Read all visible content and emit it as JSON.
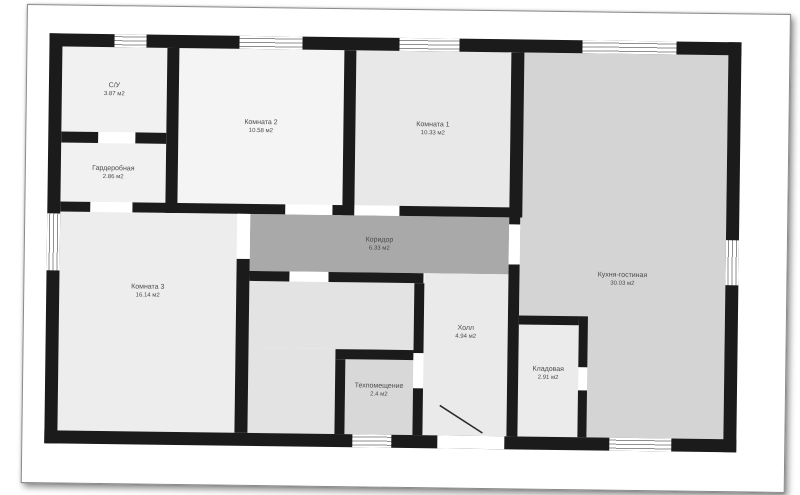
{
  "colors": {
    "wall": "#1b1b1b",
    "corridor_fill": "#a9a9a9",
    "kitchen_fill": "#d4d4d4",
    "room_fill_light": "#efefef",
    "window_line": "#8f8f8f",
    "label_text": "#4a4a4a",
    "photo_background": "#ffffff"
  },
  "plan": {
    "rooms": [
      {
        "name": "С/У",
        "area": "3.87 м2"
      },
      {
        "name": "Гардеробная",
        "area": "2.86 м2"
      },
      {
        "name": "Комната 2",
        "area": "10.58 м2"
      },
      {
        "name": "Комната 1",
        "area": "10.33 м2"
      },
      {
        "name": "Кухня-гостиная",
        "area": "30.03 м2"
      },
      {
        "name": "Коридор",
        "area": "6.33 м2"
      },
      {
        "name": "Комната 3",
        "area": "16.14 м2"
      },
      {
        "name": "Холл",
        "area": "4.94 м2"
      },
      {
        "name": "Техпомещение",
        "area": "2.4 м2"
      },
      {
        "name": "Кладовая",
        "area": "2.91 м2"
      }
    ]
  }
}
